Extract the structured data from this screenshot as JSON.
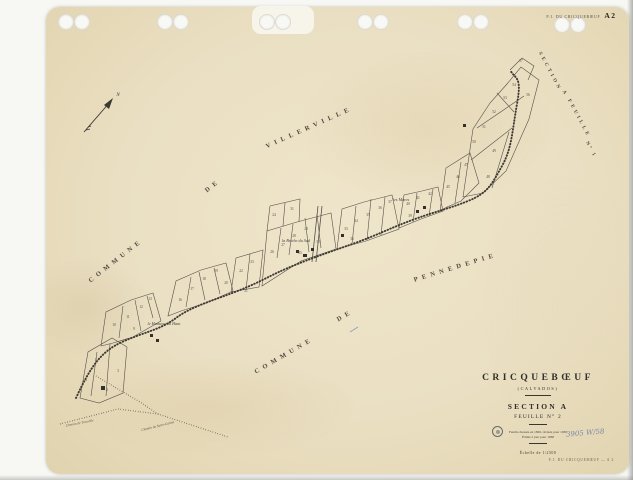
{
  "colors": {
    "paper": "#eadfc2",
    "map_ink": "#4e4840",
    "title_ink": "#322e29",
    "handwriting_blue": "#6b79a6"
  },
  "header": {
    "corner_prefix": "P.I. DU CRICQUEBŒUF",
    "corner_code": "A 2"
  },
  "title_block": {
    "commune": "CRICQUEBŒUF",
    "department": "(CALVADOS)",
    "section": "SECTION A",
    "feuille": "FEUILLE N° 2",
    "note1": "Feuille dressée en 1826, révisée pour 1936",
    "note2": "Éditée à jour pour 1968",
    "scale": "Échelle de 1/2500"
  },
  "footer": {
    "plate_label": "P.I. DU CRICQUEBŒUF — A 2",
    "handwritten_ref": "3905 W/58"
  },
  "map": {
    "north_label": "N",
    "diagonal_labels": [
      {
        "text": "COMMUNE",
        "x": 117,
        "y": 262,
        "rot": -38,
        "size": 6.5,
        "ls": 4.5
      },
      {
        "text": "DE",
        "x": 214,
        "y": 187,
        "rot": -38,
        "size": 6.5,
        "ls": 4.5
      },
      {
        "text": "VILLERVILLE",
        "x": 310,
        "y": 129,
        "rot": -24,
        "size": 6.5,
        "ls": 4.5
      },
      {
        "text": "COMMUNE",
        "x": 285,
        "y": 357,
        "rot": -30,
        "size": 6.5,
        "ls": 4.5
      },
      {
        "text": "DE",
        "x": 346,
        "y": 317,
        "rot": -30,
        "size": 6.5,
        "ls": 4.5
      },
      {
        "text": "PENNEDEPIE",
        "x": 456,
        "y": 269,
        "rot": -17,
        "size": 6.5,
        "ls": 4.5
      },
      {
        "text": "SECTION",
        "x": 549,
        "y": 72,
        "rot": 62,
        "size": 5,
        "ls": 3
      },
      {
        "text": "A",
        "x": 564,
        "y": 94,
        "rot": 62,
        "size": 5,
        "ls": 3
      },
      {
        "text": "FEUILLE",
        "x": 578,
        "y": 119,
        "rot": 62,
        "size": 5,
        "ls": 3
      },
      {
        "text": "N° 1",
        "x": 590,
        "y": 150,
        "rot": 62,
        "size": 5,
        "ls": 2
      }
    ],
    "lieu_dits": [
      {
        "text": "la Briche du Sud",
        "x": 296,
        "y": 242,
        "size": 4.2
      },
      {
        "text": "le Hameau du Haut",
        "x": 164,
        "y": 325,
        "size": 4.2
      },
      {
        "text": "les Mares",
        "x": 401,
        "y": 201,
        "size": 4.2
      }
    ],
    "road_labels": [
      {
        "text": "Chemin de Trouville",
        "x": 80,
        "y": 424,
        "rot": -11,
        "size": 3.5
      },
      {
        "text": "Chemin de Saint-Gatien",
        "x": 158,
        "y": 427,
        "rot": -14,
        "size": 3.5
      }
    ],
    "parcel_numbers": [
      [
        86,
        381,
        "4"
      ],
      [
        96,
        361,
        "5"
      ],
      [
        110,
        350,
        "6"
      ],
      [
        118,
        372,
        "3"
      ],
      [
        107,
        391,
        "2"
      ],
      [
        114,
        326,
        "10"
      ],
      [
        128,
        318,
        "11"
      ],
      [
        141,
        308,
        "12"
      ],
      [
        150,
        300,
        "13"
      ],
      [
        134,
        330,
        "9"
      ],
      [
        180,
        301,
        "16"
      ],
      [
        192,
        290,
        "17"
      ],
      [
        204,
        280,
        "18"
      ],
      [
        216,
        272,
        "19"
      ],
      [
        226,
        284,
        "20"
      ],
      [
        241,
        272,
        "22"
      ],
      [
        252,
        263,
        "23"
      ],
      [
        246,
        292,
        "21"
      ],
      [
        272,
        253,
        "26"
      ],
      [
        283,
        246,
        "27"
      ],
      [
        294,
        237,
        "28"
      ],
      [
        306,
        230,
        "29"
      ],
      [
        318,
        243,
        "30"
      ],
      [
        300,
        254,
        "25"
      ],
      [
        274,
        216,
        "24"
      ],
      [
        292,
        210,
        "31"
      ],
      [
        346,
        230,
        "33"
      ],
      [
        356,
        222,
        "34"
      ],
      [
        368,
        216,
        "35"
      ],
      [
        380,
        209,
        "36"
      ],
      [
        390,
        203,
        "37"
      ],
      [
        352,
        240,
        "32"
      ],
      [
        408,
        205,
        "40"
      ],
      [
        418,
        199,
        "41"
      ],
      [
        430,
        195,
        "42"
      ],
      [
        410,
        217,
        "39"
      ],
      [
        448,
        188,
        "45"
      ],
      [
        458,
        178,
        "46"
      ],
      [
        466,
        166,
        "47"
      ],
      [
        474,
        143,
        "50"
      ],
      [
        484,
        128,
        "51"
      ],
      [
        494,
        113,
        "52"
      ],
      [
        505,
        99,
        "53"
      ],
      [
        514,
        86,
        "54"
      ],
      [
        494,
        152,
        "49"
      ],
      [
        488,
        178,
        "48"
      ],
      [
        528,
        96,
        "56"
      ],
      [
        521,
        62,
        "57"
      ]
    ]
  }
}
